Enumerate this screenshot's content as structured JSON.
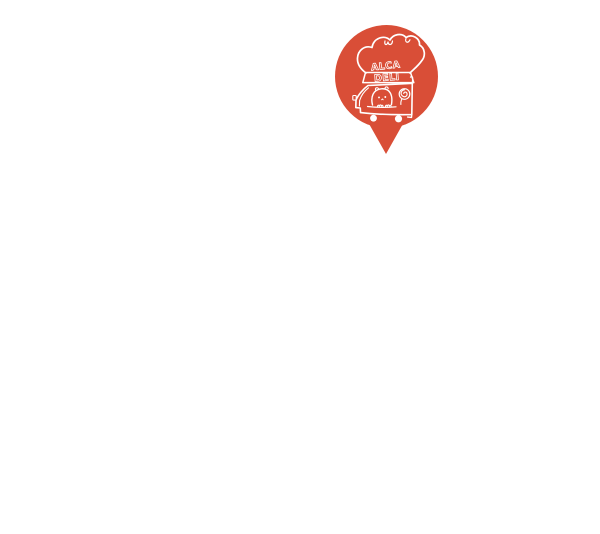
{
  "canvas": {
    "background_color": "#ffffff"
  },
  "marker": {
    "label": "ALCA DELI food-truck map pin",
    "pin_color": "#d94e37",
    "line_color": "#ffffff",
    "logo": {
      "line1": "ALCA",
      "line2": "DELI"
    }
  }
}
